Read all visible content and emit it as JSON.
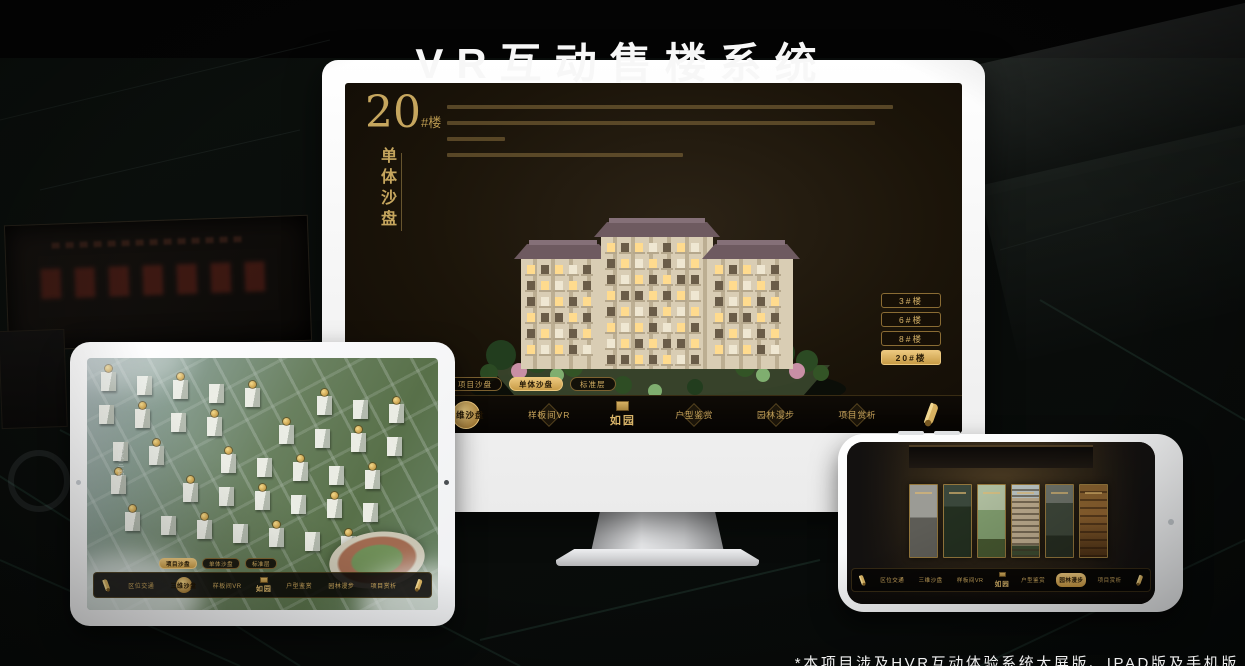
{
  "page": {
    "title": "VR互动售楼系统",
    "footnote": "*本项目涉及HVR互动体验系统大屏版、IPAD版及手机版"
  },
  "colors": {
    "gold": "#d2a855",
    "gold_deep": "#8a6a2e",
    "screen_bg": "#171107",
    "background": "#0a0d0b",
    "title_white": "#f5f5f5"
  },
  "monitor": {
    "heading_number": "20",
    "heading_suffix": "#楼",
    "heading_vertical": "单体沙盘",
    "floor_buttons": [
      "3#楼",
      "6#楼",
      "8#楼",
      "20#楼"
    ],
    "active_floor": "20#楼",
    "tabs": [
      "项目沙盘",
      "单体沙盘",
      "标准层"
    ],
    "active_tab": "单体沙盘",
    "nav_left": [
      "区位交通",
      "三维沙盘",
      "样板间VR"
    ],
    "nav_right": [
      "户型鉴赏",
      "园林漫步",
      "项目赏析"
    ],
    "active_nav": "三维沙盘",
    "logo": "如园"
  },
  "tablet": {
    "tabs": [
      "项目沙盘",
      "单体沙盘",
      "标准层"
    ],
    "active_tab": "项目沙盘",
    "nav_left": [
      "区位交通",
      "三维沙盘",
      "样板间VR"
    ],
    "nav_right": [
      "户型鉴赏",
      "园林漫步",
      "项目赏析"
    ],
    "active_nav": "三维沙盘",
    "logo": "如园",
    "road_label": "园区三路"
  },
  "phone": {
    "nav_left": [
      "区位交通",
      "三维沙盘",
      "样板间VR"
    ],
    "nav_right": [
      "户型鉴赏",
      "园林漫步",
      "项目赏析"
    ],
    "active_nav": "园林漫步",
    "logo": "如园"
  }
}
